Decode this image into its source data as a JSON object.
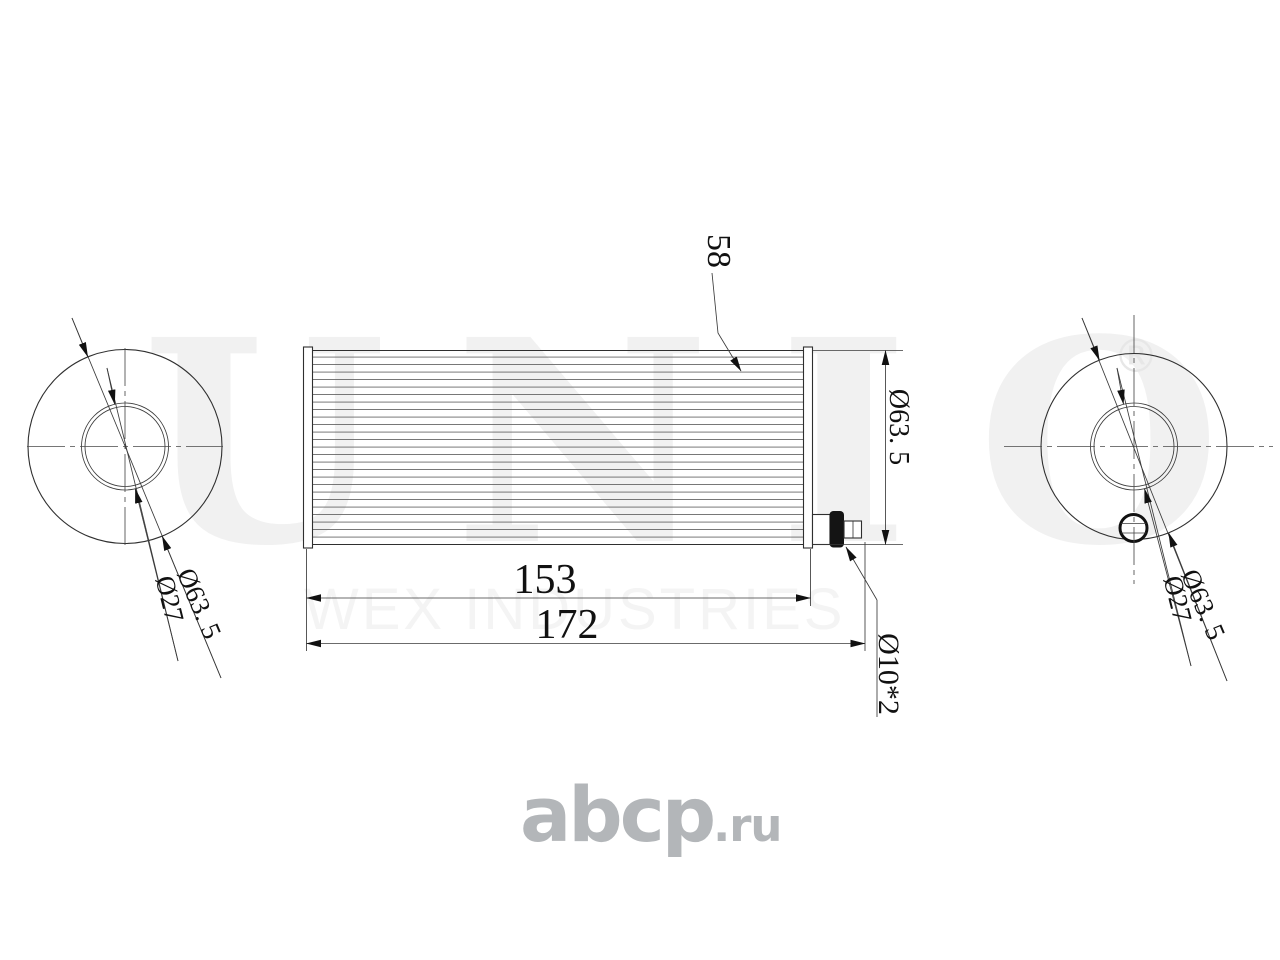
{
  "watermark": {
    "brand": "UNIO",
    "registered_mark": "®",
    "tagline": "WEX INDUSTRIES"
  },
  "logo": {
    "main": "abcp",
    "suffix": ".ru"
  },
  "dimensions": {
    "pleat_callout": "58",
    "body_diameter": "Ø63. 5",
    "element_length": "153",
    "overall_length": "172",
    "port_size": "Ø10*2",
    "left_view_outer": "Ø63. 5",
    "left_view_inner": "Ø27",
    "right_view_outer": "Ø63. 5",
    "right_view_inner": "Ø27"
  },
  "colors": {
    "line": "#2f2f2f",
    "pleat_line": "#606060",
    "watermark_brand": "#f1f1f1",
    "watermark_tagline": "#f4f4f4",
    "logo_gray": "#b3b6b9",
    "background": "#ffffff"
  }
}
